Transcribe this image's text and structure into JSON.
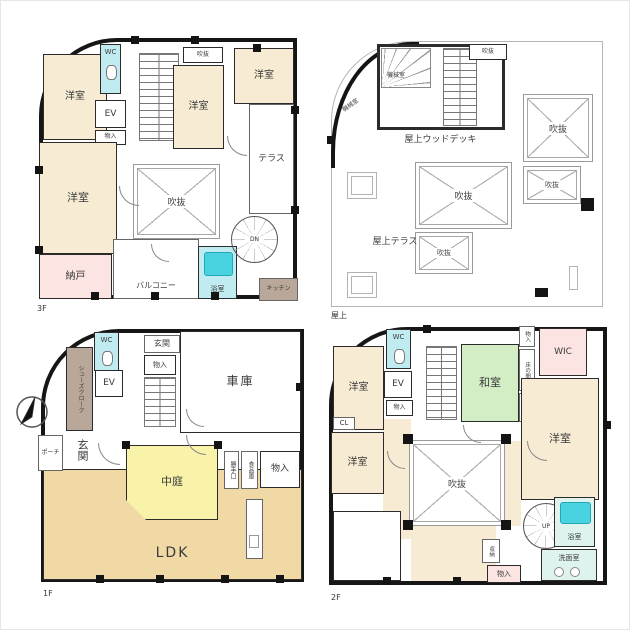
{
  "sheet": {
    "type": "floor-plan-sheet",
    "background": "#ffffff"
  },
  "colors": {
    "wall": "#161616",
    "western_room_cream": "#f7ecd3",
    "storage_pink": "#fbe4e1",
    "tatami_green": "#d3edc4",
    "courtyard_yellow": "#f8f3a9",
    "ldk_tan": "#f0d9a5",
    "bath_cyan": "#49d2df",
    "wash_lightcyan": "#def2ee",
    "cloak_taupe": "#b9a89a"
  },
  "floors": {
    "f3": {
      "label": "3F",
      "rooms": {
        "youshitsu_tl": "洋室",
        "wc": "WC",
        "ev": "EV",
        "monoire": "物入",
        "fukinuke_small": "吹抜",
        "youshitsu_mid": "洋室",
        "youshitsu_tr": "洋室",
        "terrace": "テラス",
        "youshitsu_l": "洋室",
        "fukinuke": "吹抜",
        "balcony": "バルコニー",
        "yokushitsu": "浴室",
        "nando": "納戸",
        "stairs_dn": "DN",
        "kitchen": "キッチン"
      }
    },
    "roof": {
      "label": "屋上",
      "rooms": {
        "fukinuke_top": "吹抜",
        "kikai_1": "機械室",
        "kikai_2": "機械室",
        "wood_deck": "屋上ウッドデッキ",
        "fukinuke_r1": "吹抜",
        "fukinuke_r2": "吹抜",
        "fukinuke_c1": "吹抜",
        "fukinuke_c2": "吹抜",
        "roof_terrace": "屋上テラス"
      }
    },
    "f1": {
      "label": "1F",
      "rooms": {
        "wc": "WC",
        "shoes_cloak": "シューズクローク",
        "ev": "EV",
        "genkan_hall": "玄関",
        "monoire": "物入",
        "garage": "車庫",
        "porch": "ポーチ",
        "genkan": "玄関",
        "nakaniwa": "中庭",
        "katteguchi": "勝手口",
        "shokuhinko": "食品庫",
        "monoire2": "物入",
        "ldk": "LDK"
      }
    },
    "f2": {
      "label": "2F",
      "rooms": {
        "wc": "WC",
        "youshitsu_tl": "洋室",
        "ev": "EV",
        "monoire": "物入",
        "washitsu": "和室",
        "monoire_top": "物入",
        "tokonoma": "床の間",
        "oshiire": "押入",
        "wic": "WIC",
        "cl": "CL",
        "youshitsu_l": "洋室",
        "youshitsu_r": "洋室",
        "fukinuke": "吹抜",
        "stairs_up": "UP",
        "yokushitsu": "浴室",
        "senmenshitsu": "洗面室",
        "shuno": "収納",
        "monoire_b": "物入"
      }
    }
  }
}
